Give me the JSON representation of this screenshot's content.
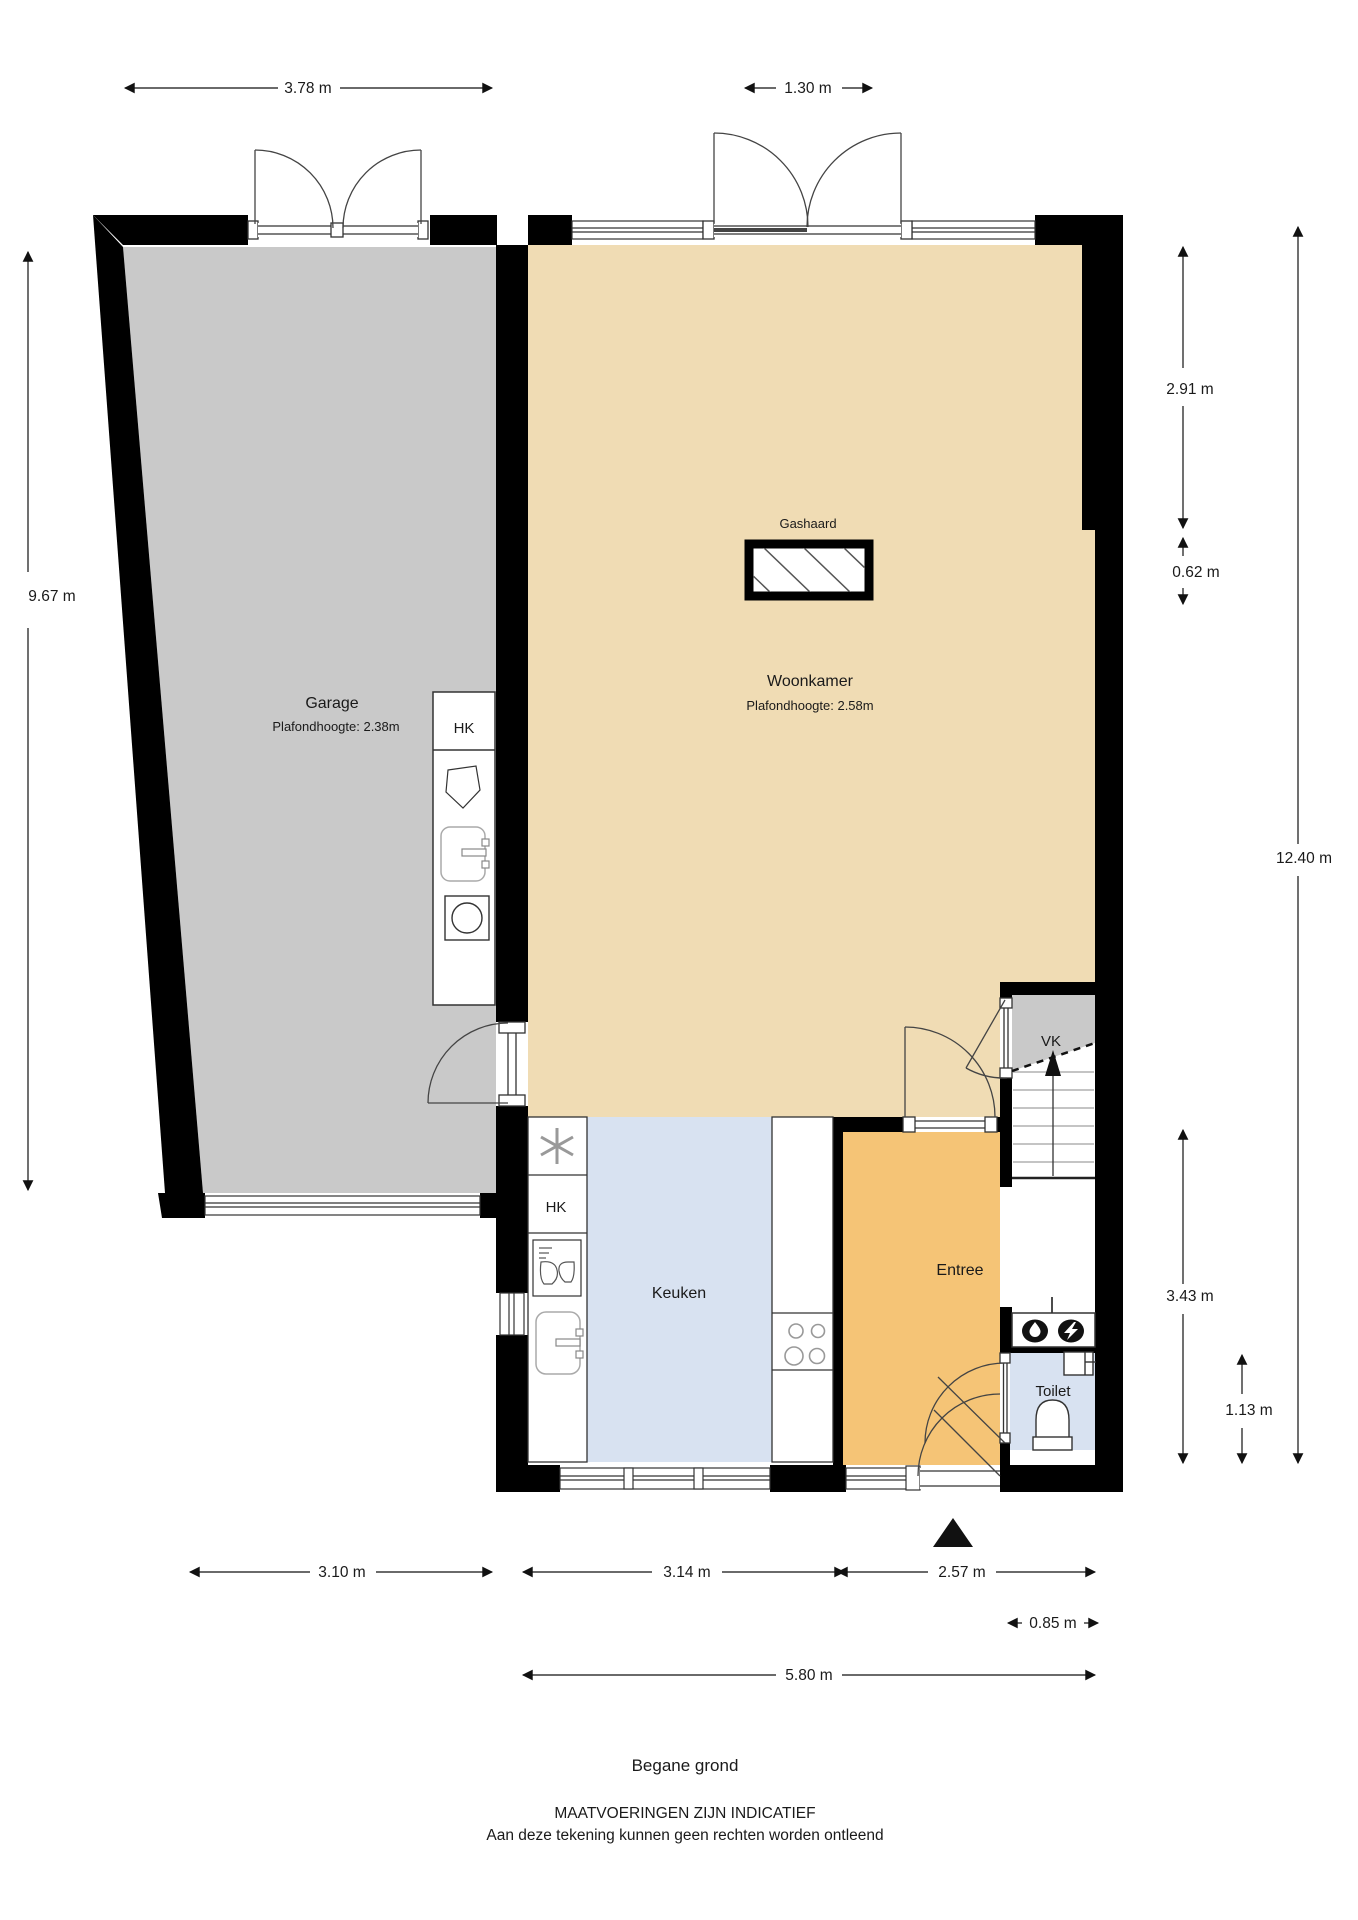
{
  "title": {
    "floor": "Begane grond",
    "notice_line1": "MAATVOERINGEN ZIJN INDICATIEF",
    "notice_line2": "Aan deze tekening kunnen geen rechten worden ontleend"
  },
  "rooms": {
    "garage": {
      "label": "Garage",
      "ceiling_height": "Plafondhoogte: 2.38m"
    },
    "woonkamer": {
      "label": "Woonkamer",
      "ceiling_height": "Plafondhoogte: 2.58m"
    },
    "keuken": {
      "label": "Keuken"
    },
    "entree": {
      "label": "Entree"
    },
    "toilet": {
      "label": "Toilet"
    },
    "vk": {
      "label": "VK"
    },
    "hk_garage": {
      "label": "HK"
    },
    "hk_keuken": {
      "label": "HK"
    },
    "gashaard": {
      "label": "Gashaard"
    }
  },
  "dimensions": {
    "garage_width": "3.78 m",
    "woonkamer_door_width": "1.30 m",
    "garage_depth": "9.67 m",
    "right_upper": "2.91 m",
    "right_nook": "0.62 m",
    "total_depth": "12.40 m",
    "entree_depth": "3.43 m",
    "toilet_depth": "1.13 m",
    "garage_bottom_width": "3.10 m",
    "keuken_width": "3.14 m",
    "entree_width": "2.57 m",
    "toilet_width": "0.85 m",
    "house_width": "5.80 m"
  },
  "icons": {
    "washing_machine": "circle-in-square",
    "laundry_sink": "rounded-basin-with-faucet",
    "wash_basin": "pentagon-basin",
    "freezer": "snowflake",
    "dishwasher": "glasses",
    "kitchen_sink": "rounded-basin-with-faucet",
    "stove": "four-burners",
    "toilet_bowl": "arched-bowl",
    "water_meter": "drop-in-oval",
    "electric_meter": "lightning-in-oval",
    "stairs_up": "arrow-up",
    "entrance_marker": "solid-triangle"
  },
  "colors": {
    "garage_floor": "#c9c9c9",
    "woonkamer_floor": "#f0dcb4",
    "keuken_floor": "#d8e2f1",
    "entree_floor": "#f5c476",
    "toilet_floor": "#d8e2f1",
    "vk_floor": "#c9c9c9",
    "wall": "#000000"
  }
}
